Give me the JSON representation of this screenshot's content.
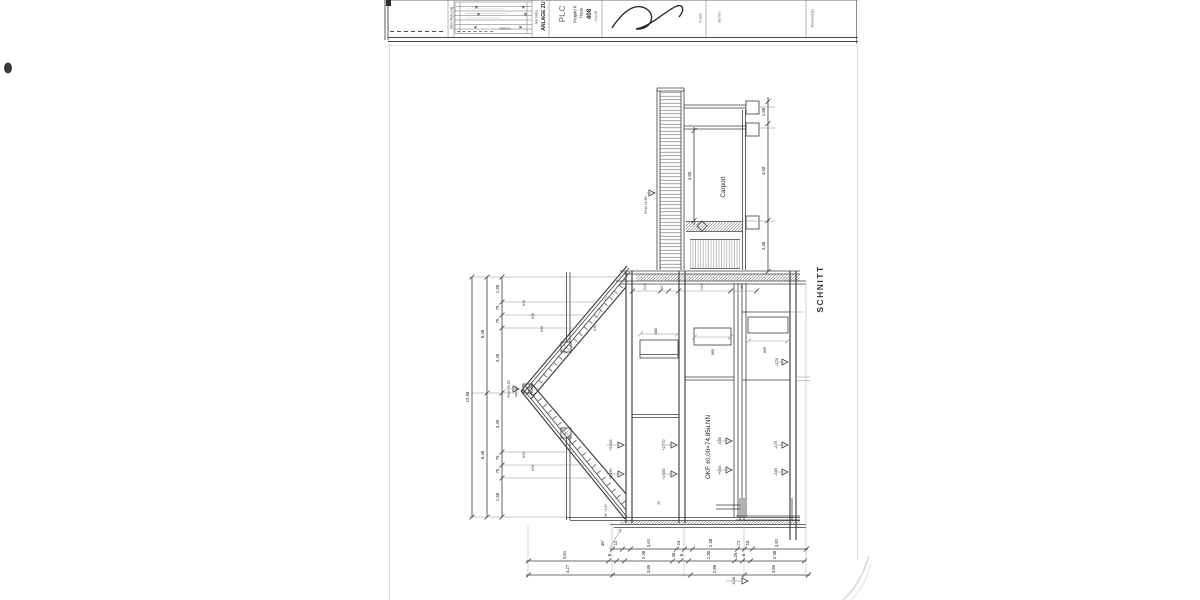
{
  "titleblock": {
    "index_label": "Index Änderung",
    "verteiler": "Verteiler",
    "alle_masse": "Alle Maße",
    "anlage": "ANLAGE ZU",
    "logo": "PLC",
    "logo_line1": "Projekt K",
    "logo_line2": "Haus",
    "logo_number": "408",
    "logo_small": "Geprüft",
    "projekt": "Projekt",
    "bauherr": "Bauherr",
    "baubeteiligte": "Baubeteiligte",
    "x_marks": [
      "×",
      "×",
      "×",
      "×",
      "×",
      "×"
    ]
  },
  "drawing": {
    "section_title": "SCHNITT",
    "carport": "Carport",
    "okf_label": "OKF ±0,00=74,85ü.NN",
    "levels": {
      "ridge": "First +8,25",
      "neighbor": "First +4,50",
      "attic_a": "+5,525",
      "attic_b": "+5,450",
      "og_a": "+2,770",
      "og_b": "+2,655",
      "eg_a": "-0,50",
      "eg_b": "+0,00",
      "kg_a": "-2,70",
      "kg_b": "-2,75",
      "kg_c": "-3,05",
      "foundation": "-6,28",
      "eave": "OK +1,63"
    },
    "notes": {
      "rafter": "8/16",
      "angle": "45°",
      "n1": "8/16",
      "n2": "8/16",
      "n3": "8/16",
      "n4": "8/16",
      "n5": "8/16",
      "zone2_small": "26"
    },
    "dims": {
      "carport_left": "4,50",
      "carport_right": [
        "1,88",
        "4,50",
        "3,48"
      ],
      "top_row": [
        "3,01",
        "92",
        "2,61",
        "86"
      ],
      "win": [
        "885",
        "865",
        "865"
      ],
      "left_total": "12,98",
      "left_half_a": "6,48",
      "left_half_b": "6,48",
      "left_detail": [
        "1,90",
        "75",
        "75",
        "3,49",
        "3,49",
        "75",
        "75",
        "1,50"
      ],
      "row1": [
        "12",
        "3,61",
        "24",
        "2,38",
        "71",
        "16",
        "3,81"
      ],
      "row2": [
        "3,61",
        "8",
        "2,38",
        "36",
        "8",
        "2,30",
        "26",
        "8",
        "2,38"
      ],
      "row3": [
        "4,27",
        "3,85",
        "2,86",
        "3,85"
      ]
    }
  }
}
